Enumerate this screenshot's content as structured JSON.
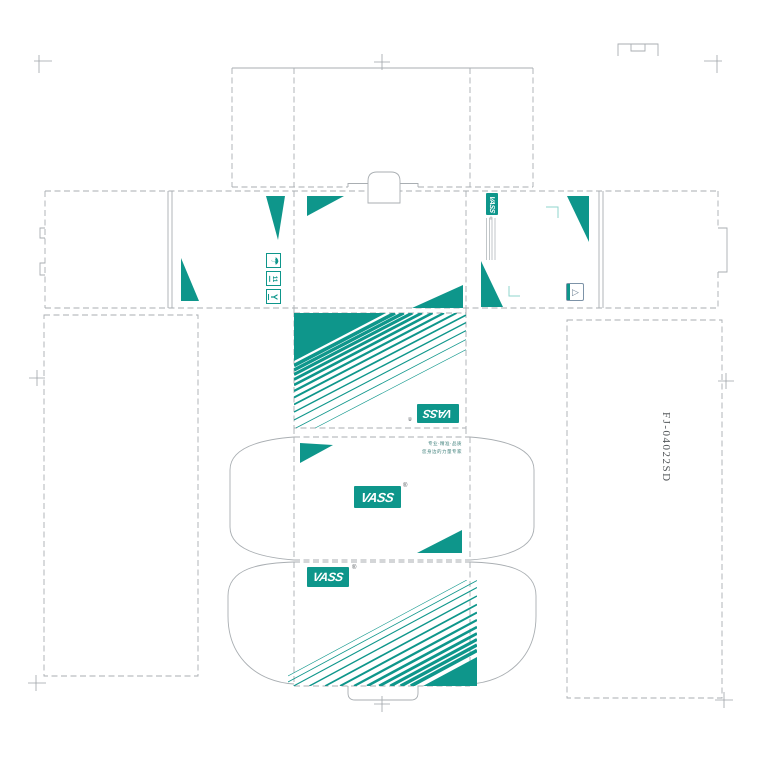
{
  "brand": {
    "logo_text": "VASS",
    "registered_mark": "®"
  },
  "product_code": "FJ-04022SD",
  "slogan": {
    "line1": "专业·精准·品质",
    "line2": "您身边的力量专家"
  },
  "handling_icons": {
    "keep_dry_glyph": "☂",
    "stack_limit_glyph": "11",
    "fragile_glyph": "Y"
  },
  "colors": {
    "teal": "#0E968B",
    "teal_light": "#8FD6CE",
    "dieline_gray": "#A9AEB2",
    "code_text": "#54585B"
  }
}
